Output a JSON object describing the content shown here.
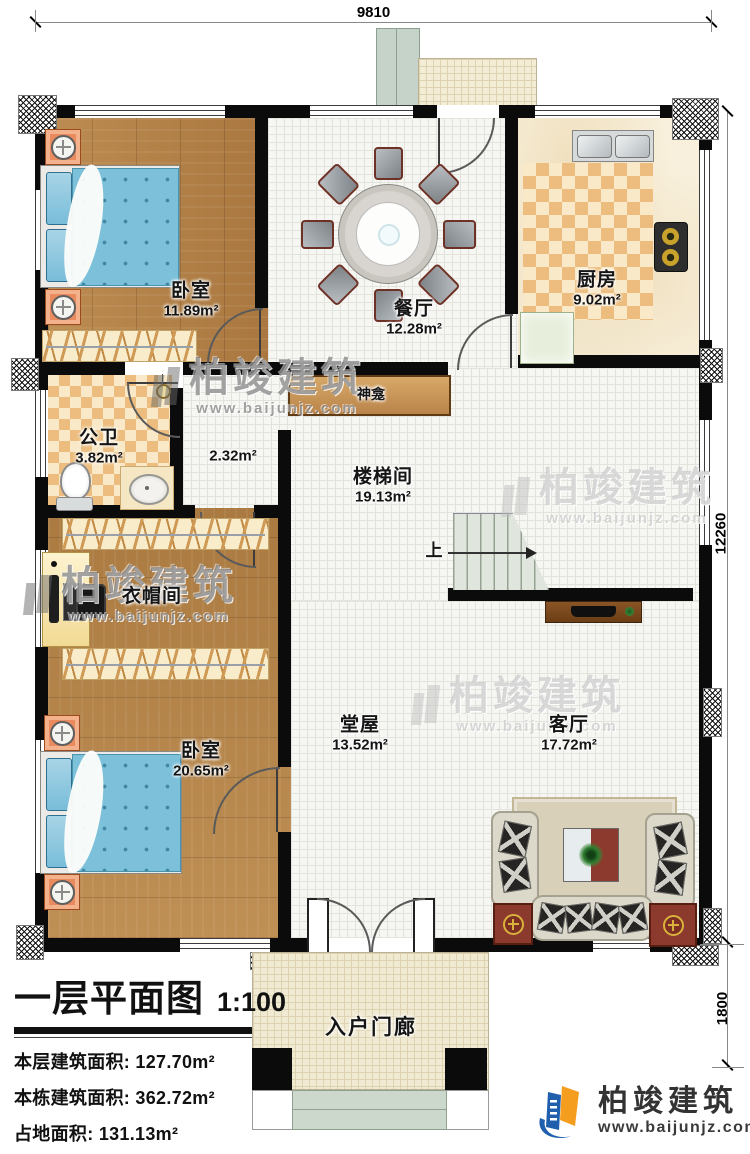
{
  "meta": {
    "title": "一层平面图",
    "scale": "1:100",
    "stats": [
      {
        "label": "本层建筑面积:",
        "value": "127.70m²"
      },
      {
        "label": "本栋建筑面积:",
        "value": "362.72m²"
      },
      {
        "label": "占地面积:",
        "value": "131.13m²"
      },
      {
        "label": "层高:",
        "value": "3.6m"
      }
    ]
  },
  "dimensions": {
    "top_width": "9810",
    "right_height": "12260",
    "porch_depth": "1800"
  },
  "rooms": {
    "bedroom1": {
      "name": "卧室",
      "area": "11.89m²"
    },
    "dining": {
      "name": "餐厅",
      "area": "12.28m²"
    },
    "kitchen": {
      "name": "厨房",
      "area": "9.02m²"
    },
    "bath": {
      "name": "公卫",
      "area": "3.82m²"
    },
    "hallway": {
      "area": "2.32m²"
    },
    "stairhall": {
      "name": "楼梯间",
      "area": "19.13m²"
    },
    "cloakroom": {
      "name": "衣帽间"
    },
    "bedroom2": {
      "name": "卧室",
      "area": "20.65m²"
    },
    "mainhall": {
      "name": "堂屋",
      "area": "13.52m²"
    },
    "living": {
      "name": "客厅",
      "area": "17.72m²"
    },
    "porch": {
      "name": "入户门廊"
    },
    "shrine": {
      "name": "神龛"
    }
  },
  "stairs": {
    "up_label": "上"
  },
  "watermark": {
    "brand": "柏竣建筑",
    "url": "www.baijunjz.com"
  },
  "logo": {
    "brand": "柏竣建筑",
    "url": "www.baijunjz.com",
    "blue": "#1f5fae",
    "orange": "#f59d1e"
  }
}
